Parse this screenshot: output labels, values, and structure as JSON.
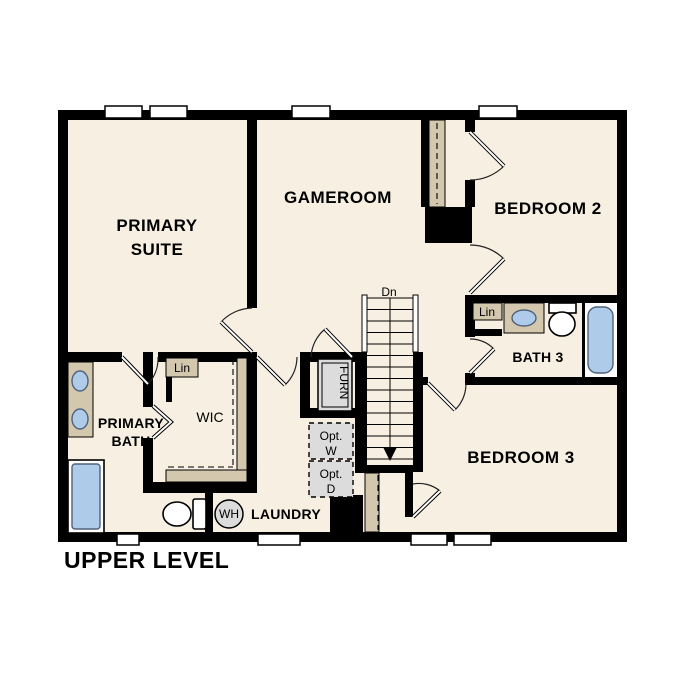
{
  "colors": {
    "background": "#ffffff",
    "wall": "#000000",
    "floor": "#f7f0e2",
    "accent_tan": "#d3c7ae",
    "fixture_blue": "#aecbea",
    "equipment_gray": "#dcdcdc"
  },
  "plan": {
    "title": "UPPER LEVEL",
    "rooms": {
      "primary_suite": {
        "line1": "PRIMARY",
        "line2": "SUITE"
      },
      "gameroom": {
        "label": "GAMEROOM"
      },
      "bedroom_2": {
        "label": "BEDROOM 2"
      },
      "bedroom_3": {
        "label": "BEDROOM 3"
      },
      "bath_3": {
        "label": "BATH 3"
      },
      "primary_bath": {
        "line1": "PRIMARY",
        "line2": "BATH"
      },
      "wic": {
        "label": "WIC"
      },
      "laundry": {
        "label": "LAUNDRY"
      }
    },
    "features": {
      "stair_direction": "Dn",
      "linen_wic": "Lin",
      "linen_bath3": "Lin",
      "furnace": "FURN",
      "opt_washer": {
        "line1": "Opt.",
        "line2": "W"
      },
      "opt_dryer": {
        "line1": "Opt.",
        "line2": "D"
      },
      "water_heater": "WH"
    }
  }
}
